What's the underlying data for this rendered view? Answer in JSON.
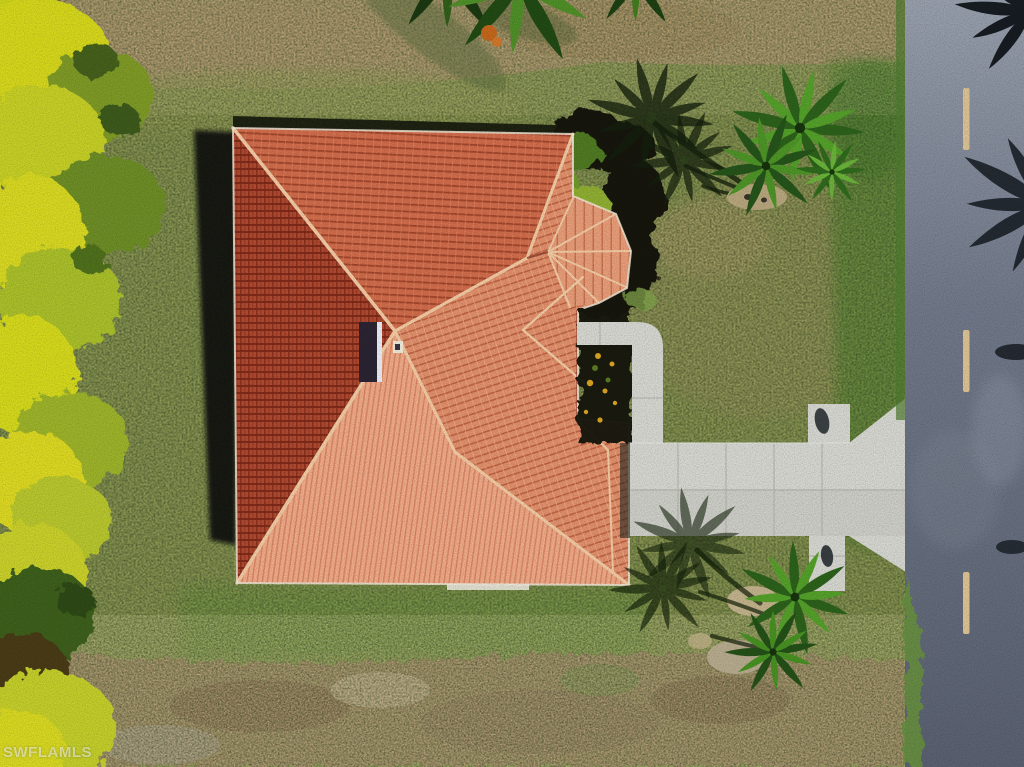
{
  "scene": {
    "type": "aerial-drone-photo",
    "description": "Overhead aerial view of a single-family home with a terracotta barrel-tile hip roof, concrete walkway and driveway leading to a two-lane road, surrounded by lawn, yellow-green hedges and palm trees casting long shadows",
    "watermark": "SWFLAMLS"
  },
  "road": {
    "orientation": "vertical",
    "lane_dashes_visible": 3
  },
  "house": {
    "skylights_visible": 1,
    "roof_type": "tile-hip"
  },
  "palette": {
    "grassBase": "#8f9b57",
    "grassDry": "#b29a72",
    "grassGreen": "#679040",
    "dirt": "#a18a66",
    "hedgeYellow": "#d6d71f",
    "mulch": "#15180e",
    "roofDark": "#b14a31",
    "roofDarkLine": "#7c2817",
    "roofMid": "#d06c4b",
    "roofMidLine": "#9a3f27",
    "roofLight": "#e2906c",
    "roofLightLine": "#b5593a",
    "roofSun": "#f0ab89",
    "roofSunLine": "#d27b57",
    "roofBay": "#e89d79",
    "ridge": "#f2cba4",
    "concrete": "#d6d7d1",
    "concreteJoint": "#aeafa8",
    "roadLight": "#939baa",
    "roadMid": "#747c8c",
    "roadDark": "#5c6373",
    "dash": "#dcc393",
    "palmDark": "#2c611b",
    "palmLight": "#54a02a",
    "shadow": "#131c10",
    "skylight": "#2b2433",
    "flower": "#d9a422",
    "eave": "#f0e6d6"
  }
}
